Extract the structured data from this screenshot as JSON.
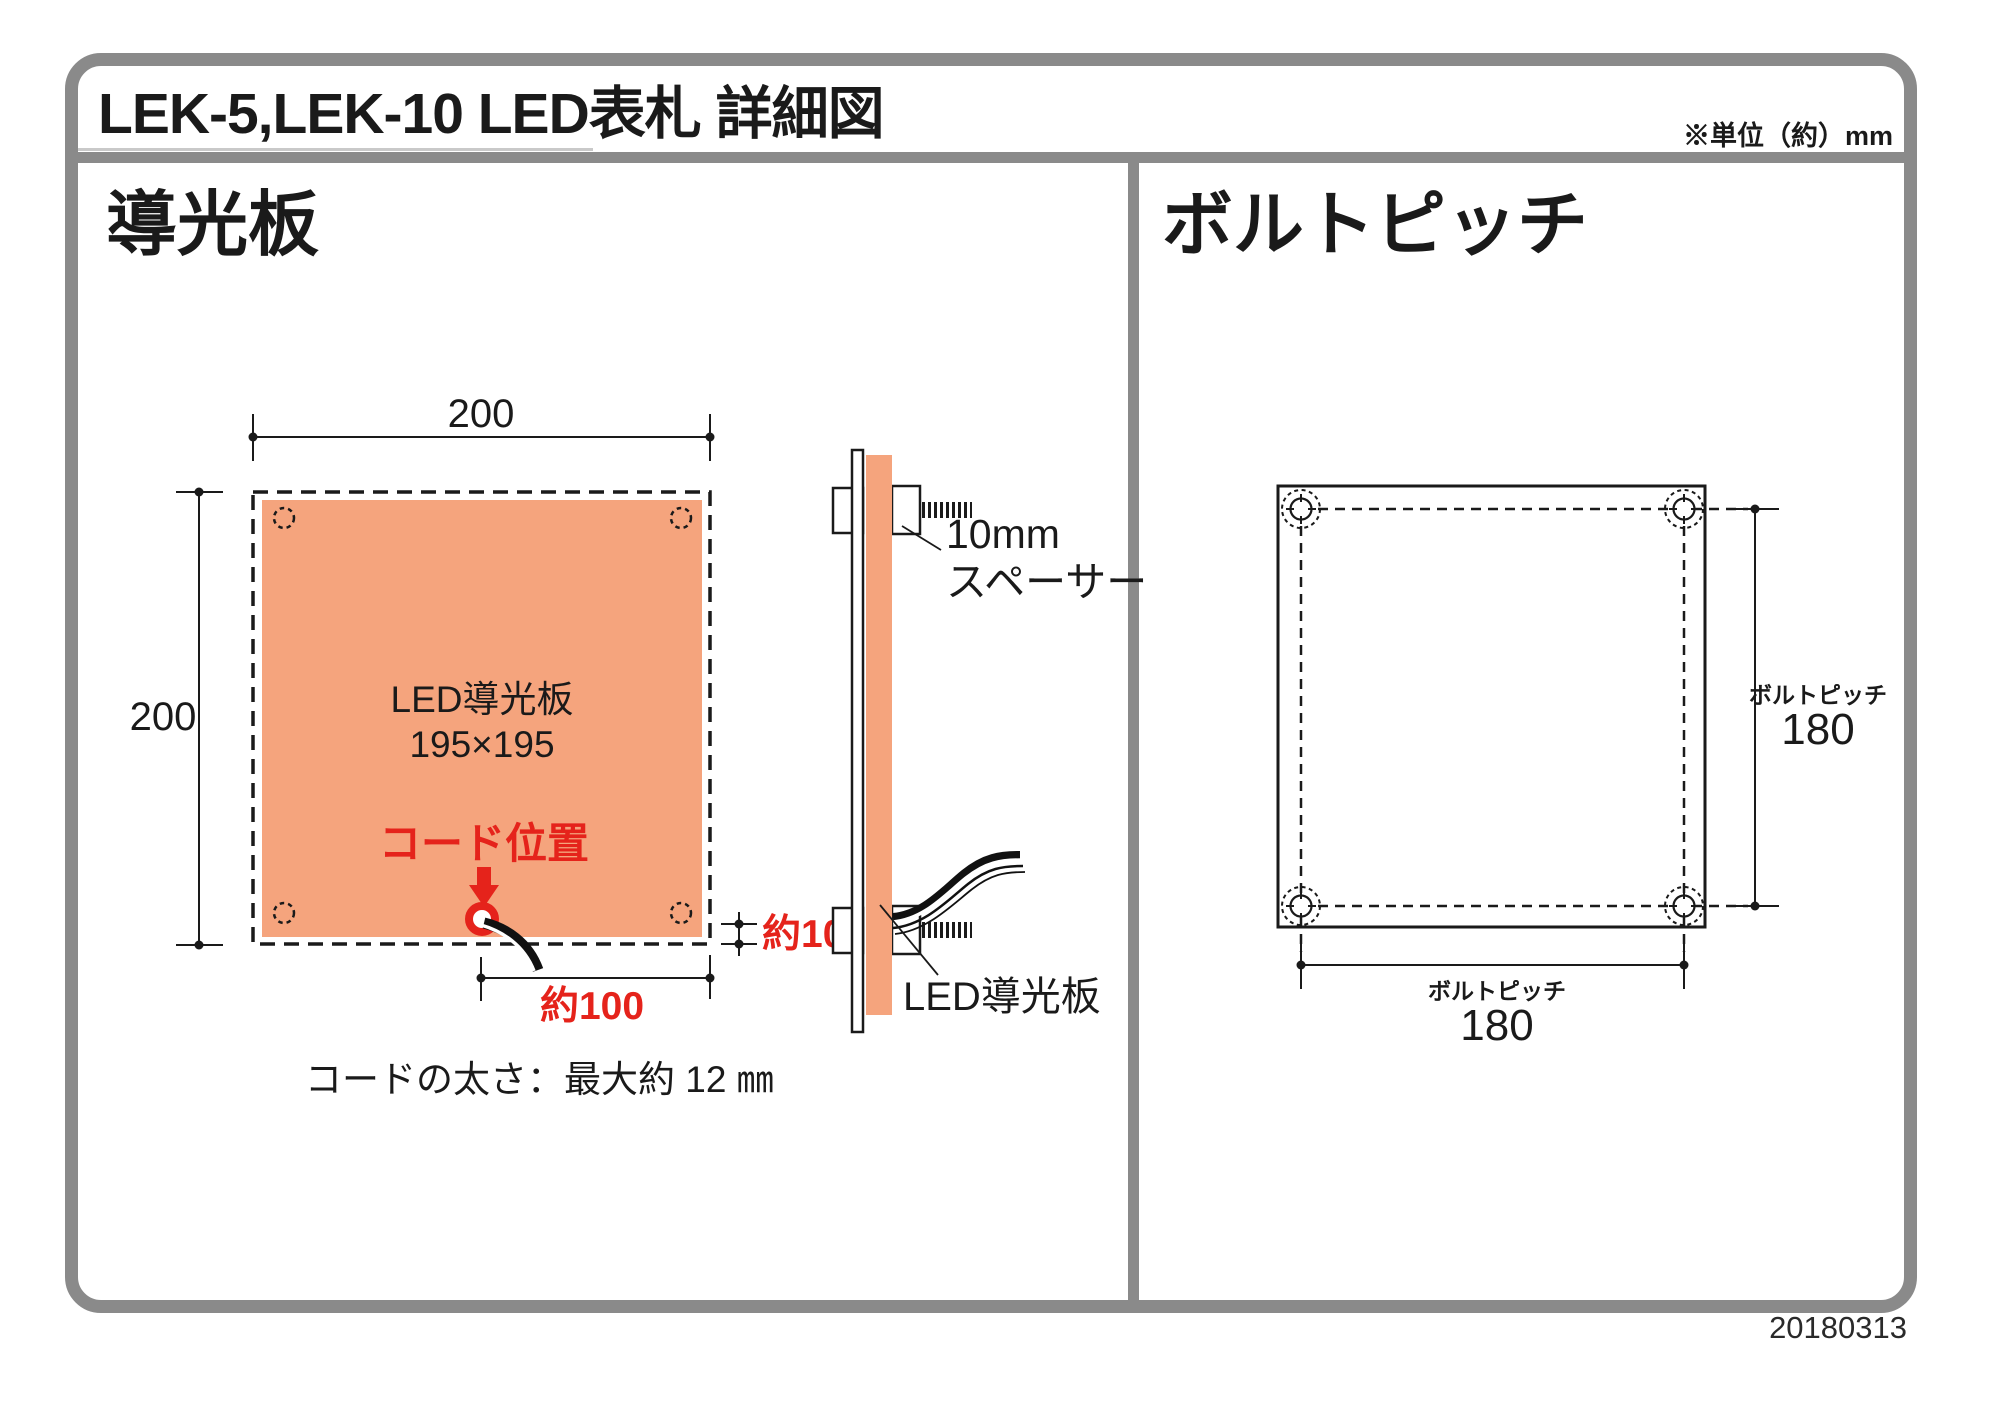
{
  "page": {
    "title": "LEK-5,LEK-10 LED表札 詳細図",
    "unit_note": "※単位（約）mm",
    "date": "20180313"
  },
  "left_panel": {
    "heading": "導光板",
    "front_view": {
      "top_dim": "200",
      "left_dim": "200",
      "plate_name": "LED導光板",
      "plate_size": "195×195",
      "cord_pos_label": "コード位置",
      "cord_x_dim": "約100",
      "edge_gap_dim": "約10",
      "cord_note": "コードの太さ：最大約 12 ㎜"
    },
    "side_view": {
      "spacer_size": "10mm",
      "spacer_name": "スペーサー",
      "plate_name": "LED導光板"
    }
  },
  "right_panel": {
    "heading": "ボルトピッチ",
    "v_dim_label": "ボルトピッチ",
    "v_dim_value": "180",
    "h_dim_label": "ボルトピッチ",
    "h_dim_value": "180"
  },
  "colors": {
    "plate_fill": "#F5A47D",
    "accent_red": "#E5231B",
    "frame_gray": "#8A8A8A",
    "line_black": "#1A1A1A"
  }
}
